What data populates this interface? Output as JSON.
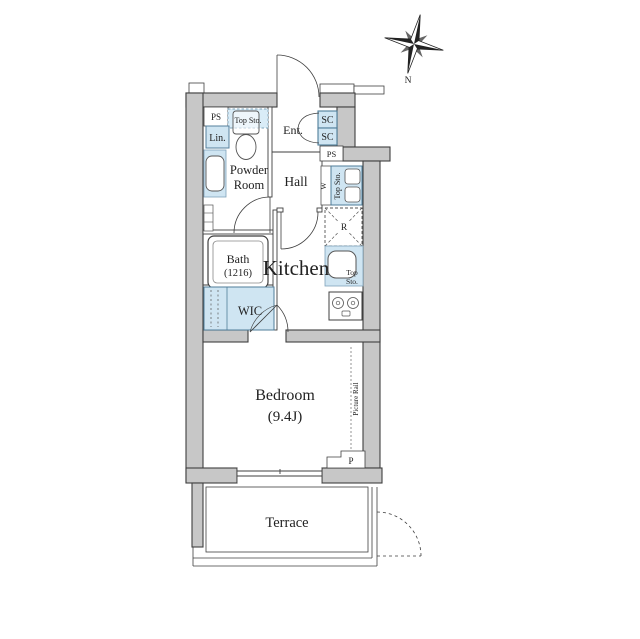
{
  "compass": {
    "north": "N"
  },
  "rooms": {
    "entrance": "Ent.",
    "hall": "Hall",
    "powder_line1": "Powder",
    "powder_line2": "Room",
    "kitchen": "Kitchen",
    "bath_line1": "Bath",
    "bath_line2": "(1216)",
    "wic": "WIC",
    "bedroom_line1": "Bedroom",
    "bedroom_line2": "(9.4J)",
    "terrace": "Terrace"
  },
  "fixtures": {
    "ps_left": "PS",
    "ps_right": "PS",
    "sc_upper": "SC",
    "sc_lower": "SC",
    "linen": "Lin.",
    "toilet_storage": "Top Sto.",
    "washer": "W",
    "washer_storage": "Top Sto.",
    "fridge": "R",
    "sink_storage_line1": "Top",
    "sink_storage_line2": "Sto.",
    "pipe_space": "P",
    "picture_rail": "Picture Rail"
  },
  "colors": {
    "wall": "#c7c7c7",
    "fixture": "#cfe5f2",
    "outline": "#3f3f3f"
  }
}
